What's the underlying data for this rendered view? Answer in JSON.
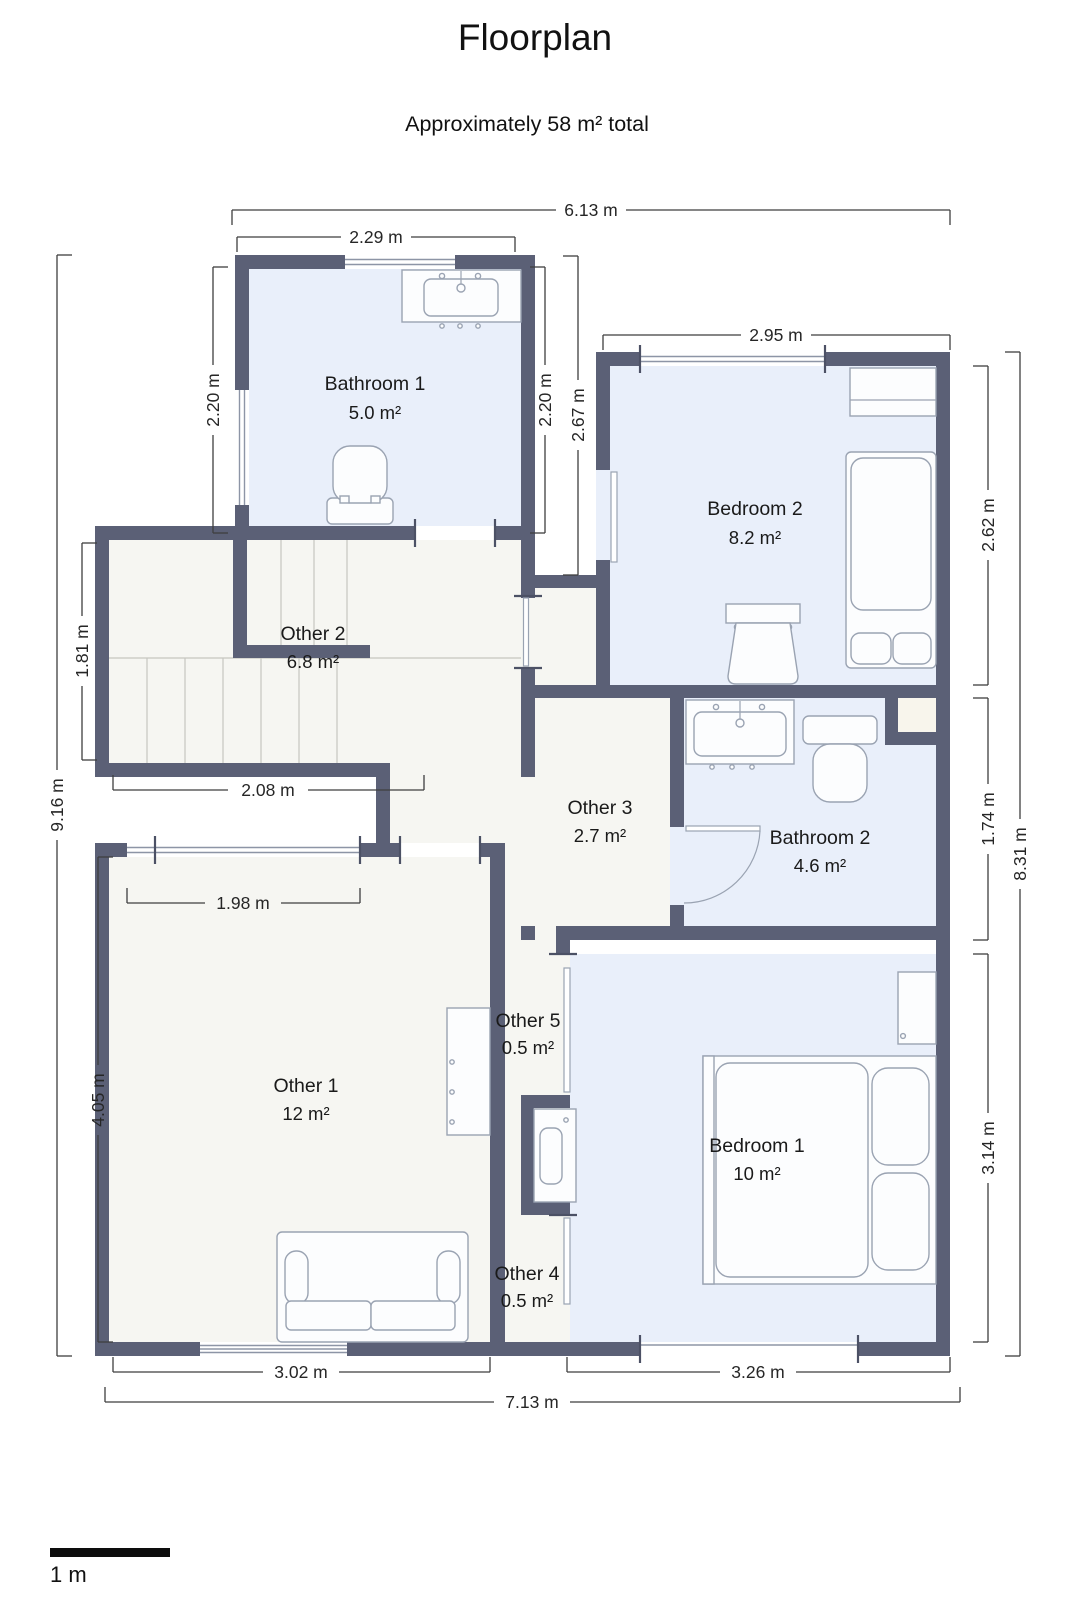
{
  "title": "Floorplan",
  "subtitle": "Approximately 58 m² total",
  "scale_bar": {
    "label": "1 m"
  },
  "colors": {
    "wall": "#5b6076",
    "wet_room_floor": "#e9effa",
    "other_room_floor": "#f6f6f2",
    "alcove_floor": "#f8f5ec",
    "dimension_text": "#262626"
  },
  "rooms": [
    {
      "name": "Bathroom 1",
      "area": "5.0 m²"
    },
    {
      "name": "Bedroom 2",
      "area": "8.2 m²"
    },
    {
      "name": "Other 2",
      "area": "6.8 m²"
    },
    {
      "name": "Other 3",
      "area": "2.7 m²"
    },
    {
      "name": "Bathroom 2",
      "area": "4.6 m²"
    },
    {
      "name": "Other 1",
      "area": "12 m²"
    },
    {
      "name": "Other 5",
      "area": "0.5 m²"
    },
    {
      "name": "Bedroom 1",
      "area": "10 m²"
    },
    {
      "name": "Other 4",
      "area": "0.5 m²"
    }
  ],
  "dimensions": {
    "top_total": "6.13 m",
    "bathroom1_width": "2.29 m",
    "bedroom2_width": "2.95 m",
    "left_total": "9.16 m",
    "bathroom1_height_left": "2.20 m",
    "bathroom1_height_right": "2.20 m",
    "corridor_height": "2.67 m",
    "other2_height": "1.81 m",
    "other1_height": "4.05 m",
    "bedroom2_height": "2.62 m",
    "bathroom2_height": "1.74 m",
    "bedroom1_height": "3.14 m",
    "right_total": "8.31 m",
    "other2_width": "2.08 m",
    "other1_window_width": "1.98 m",
    "other1_width": "3.02 m",
    "bedroom1_width": "3.26 m",
    "bottom_total": "7.13 m"
  }
}
